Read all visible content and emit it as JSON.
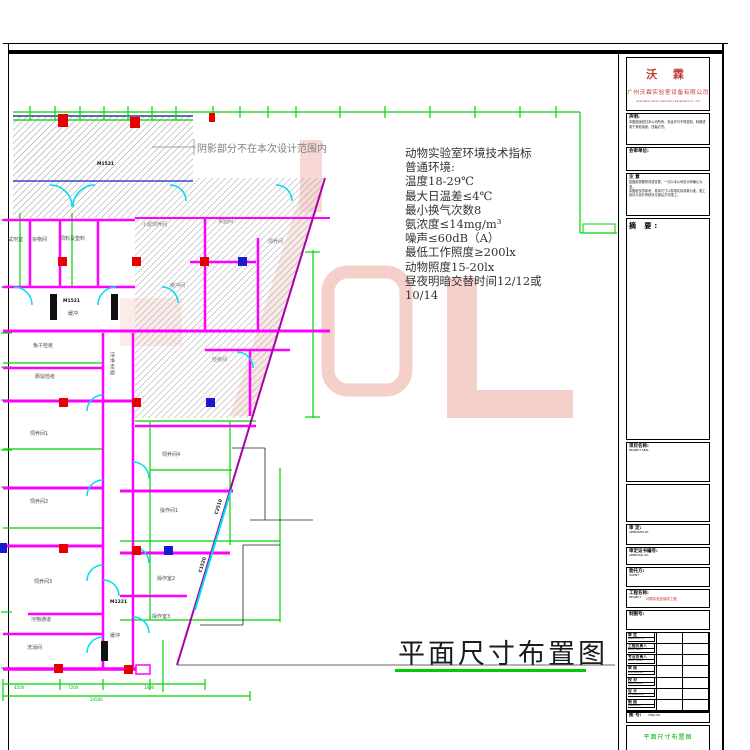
{
  "plan": {
    "note_text": "阴影部分不在本次设计范围内",
    "rooms": [
      "试剂室",
      "杂物间",
      "饲料及垫料",
      "缓冲",
      "兔子检疫",
      "豚鼠检疫",
      "洁净走廊",
      "饲养间1",
      "饲养间2",
      "饲养间3",
      "饲养间4",
      "操作间1",
      "操作室2",
      "操作室3",
      "污物通道",
      "洗消间",
      "缓冲",
      "小鼠饲养间",
      "实验间",
      "饲养间",
      "检疫间",
      "缓冲间"
    ],
    "door_codes": [
      "M1521",
      "M1521",
      "M1221"
    ],
    "window_codes": [
      "C2510",
      "C1520"
    ],
    "dim_numbers": [
      "4500",
      "7200",
      "1800",
      "24500"
    ]
  },
  "tech_specs": {
    "lines": [
      "动物实验室环境技术指标",
      "普通环境:",
      "温度18-29℃",
      "最大日温差≤4℃",
      "最小换气次数8",
      "氨浓度≤14mg/m³",
      "噪声≤60dB（A）",
      "最低工作照度≥200lx",
      "动物照度15-20lx",
      "昼夜明暗交替时间12/12或",
      "10/14"
    ]
  },
  "drawing_title": "平面尺寸布置图",
  "title_block": {
    "company": {
      "name": "沃 霖",
      "cn": "广州沃霖实验室设备有限公司",
      "en": "Guangzhou Wolin Laboratory Equipment Co., Ltd"
    },
    "statement": {
      "label": "声明:",
      "body": "本图纸版权归本公司所有，未经许可不得复制、转借或用于其他用途，违者必究。"
    },
    "review_unit": {
      "label": "会审单位:"
    },
    "notice": {
      "label": "注 意",
      "body1": "如图纸需要修改或变更，一切以本公司设计师确认为准。",
      "body2": "本图纸仅供参考，具体尺寸以现场实际测量为准，施工前请与设计师核对无误后方可施工。"
    },
    "summary": {
      "label": "摘 要:"
    },
    "project_seal": {
      "label": "项目名称:",
      "sub": "PROJECT SEAL"
    },
    "approved": {
      "label": "审 定:",
      "sub": "APPROVED BY"
    },
    "approval_no": {
      "label": "审定证书编号:",
      "sub": "APPROVAL No."
    },
    "client": {
      "label": "委托方:",
      "sub": "CLIENT"
    },
    "project": {
      "label": "工程名称:",
      "sub": "PROJECT",
      "value": "动物实验室装修工程"
    },
    "drawing_no_box": {
      "label": "制图号:"
    },
    "sign_rows": [
      {
        "cn": "审 定",
        "en": "APPROVED BY"
      },
      {
        "cn": "工程负责人",
        "en": "PROJ. MGR."
      },
      {
        "cn": "专业负责人",
        "en": "SPEC. HEAD"
      },
      {
        "cn": "审 核",
        "en": "CHECKED BY"
      },
      {
        "cn": "校 对",
        "en": "PROOFREAD"
      },
      {
        "cn": "设 计",
        "en": "DESIGNED BY"
      },
      {
        "cn": "制 图",
        "en": "DRAWN BY"
      }
    ],
    "dwg_no": {
      "cn": "图 号:",
      "en": "DWG No."
    },
    "footer_title": "平面尺寸布置图"
  },
  "colors": {
    "wall": "#ff00ff",
    "dimension": "#00d400",
    "door": "#00dcf0",
    "equip_red": "#e60000",
    "equip_blue": "#1a1acd",
    "watermark": "#f5cfc9",
    "diagonal": "#aa00aa",
    "title_underline": "#00cc00"
  }
}
